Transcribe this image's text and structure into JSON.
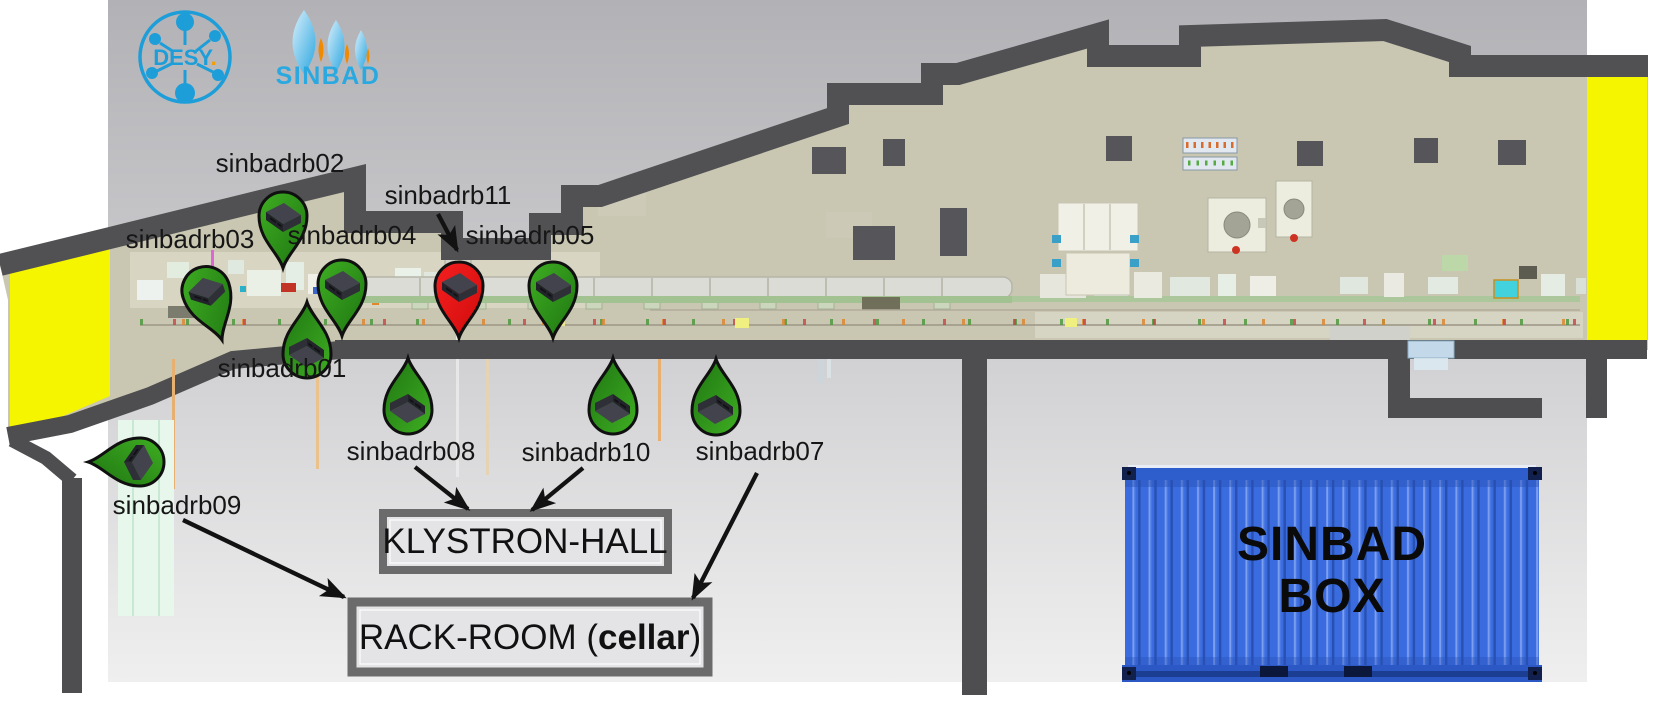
{
  "page": {
    "width": 1661,
    "height": 723
  },
  "logos": {
    "desy": {
      "text": "DESY",
      "dot": ".",
      "color": "#1e9ed9",
      "accent": "#f59e00"
    },
    "sinbad": {
      "text": "SINBAD",
      "color": "#2aa9e1",
      "accent": "#f08a00"
    }
  },
  "facility": {
    "wall_color": "#4e4e51",
    "hall_floor_color": "#c9c7b1",
    "safety_yellow": "#f5f500",
    "background_top": "#b2b2b6",
    "background_bottom": "#efefef",
    "door_color": "#c3d9ea"
  },
  "pin_colors": {
    "green": "#2e9117",
    "red": "#ee1414",
    "outline": "#101010"
  },
  "markers": [
    {
      "id": "sinbadrb02",
      "label": "sinbadrb02",
      "variant": "green",
      "tip": [
        283,
        268
      ],
      "rot": 0,
      "label_pos": [
        280,
        172
      ]
    },
    {
      "id": "sinbadrb03",
      "label": "sinbadrb03",
      "variant": "green",
      "tip": [
        222,
        340
      ],
      "rot": -18,
      "label_pos": [
        190,
        248
      ]
    },
    {
      "id": "sinbadrb04",
      "label": "sinbadrb04",
      "variant": "green",
      "tip": [
        342,
        336
      ],
      "rot": 0,
      "label_pos": [
        352,
        244
      ]
    },
    {
      "id": "sinbadrb11",
      "label": "sinbadrb11",
      "variant": "red",
      "tip": [
        459,
        338
      ],
      "rot": 0,
      "label_pos": [
        448,
        204
      ]
    },
    {
      "id": "sinbadrb05",
      "label": "sinbadrb05",
      "variant": "green",
      "tip": [
        553,
        338
      ],
      "rot": 0,
      "label_pos": [
        530,
        244
      ]
    },
    {
      "id": "sinbadrb01",
      "label": "sinbadrb01",
      "variant": "green",
      "tip": [
        307,
        302
      ],
      "rot": 180,
      "label_pos": [
        282,
        377
      ]
    },
    {
      "id": "sinbadrb08",
      "label": "sinbadrb08",
      "variant": "green",
      "tip": [
        408,
        358
      ],
      "rot": 180,
      "label_pos": [
        411,
        460
      ]
    },
    {
      "id": "sinbadrb10",
      "label": "sinbadrb10",
      "variant": "green",
      "tip": [
        613,
        358
      ],
      "rot": 180,
      "label_pos": [
        586,
        461
      ]
    },
    {
      "id": "sinbadrb07",
      "label": "sinbadrb07",
      "variant": "green",
      "tip": [
        716,
        359
      ],
      "rot": 180,
      "label_pos": [
        760,
        460
      ]
    },
    {
      "id": "sinbadrb09",
      "label": "sinbadrb09",
      "variant": "green",
      "tip": [
        88,
        462
      ],
      "rot": 90,
      "label_pos": [
        177,
        514
      ]
    }
  ],
  "rooms": {
    "klystron": {
      "label": "KLYSTRON-HALL",
      "rect": [
        383,
        513,
        285,
        57
      ]
    },
    "rack": {
      "prefix": "RACK-ROOM (",
      "bold": "cellar",
      "suffix": ")",
      "rect": [
        352,
        602,
        356,
        70
      ]
    }
  },
  "container": {
    "line1": "SINBAD",
    "line2": "BOX",
    "color": "#3a6ce0"
  },
  "arrows": [
    {
      "from": [
        438,
        214
      ],
      "to": [
        457,
        250
      ]
    },
    {
      "from": [
        415,
        467
      ],
      "to": [
        468,
        509
      ]
    },
    {
      "from": [
        583,
        468
      ],
      "to": [
        532,
        510
      ]
    },
    {
      "from": [
        757,
        473
      ],
      "to": [
        693,
        598
      ]
    },
    {
      "from": [
        183,
        520
      ],
      "to": [
        344,
        597
      ]
    }
  ]
}
